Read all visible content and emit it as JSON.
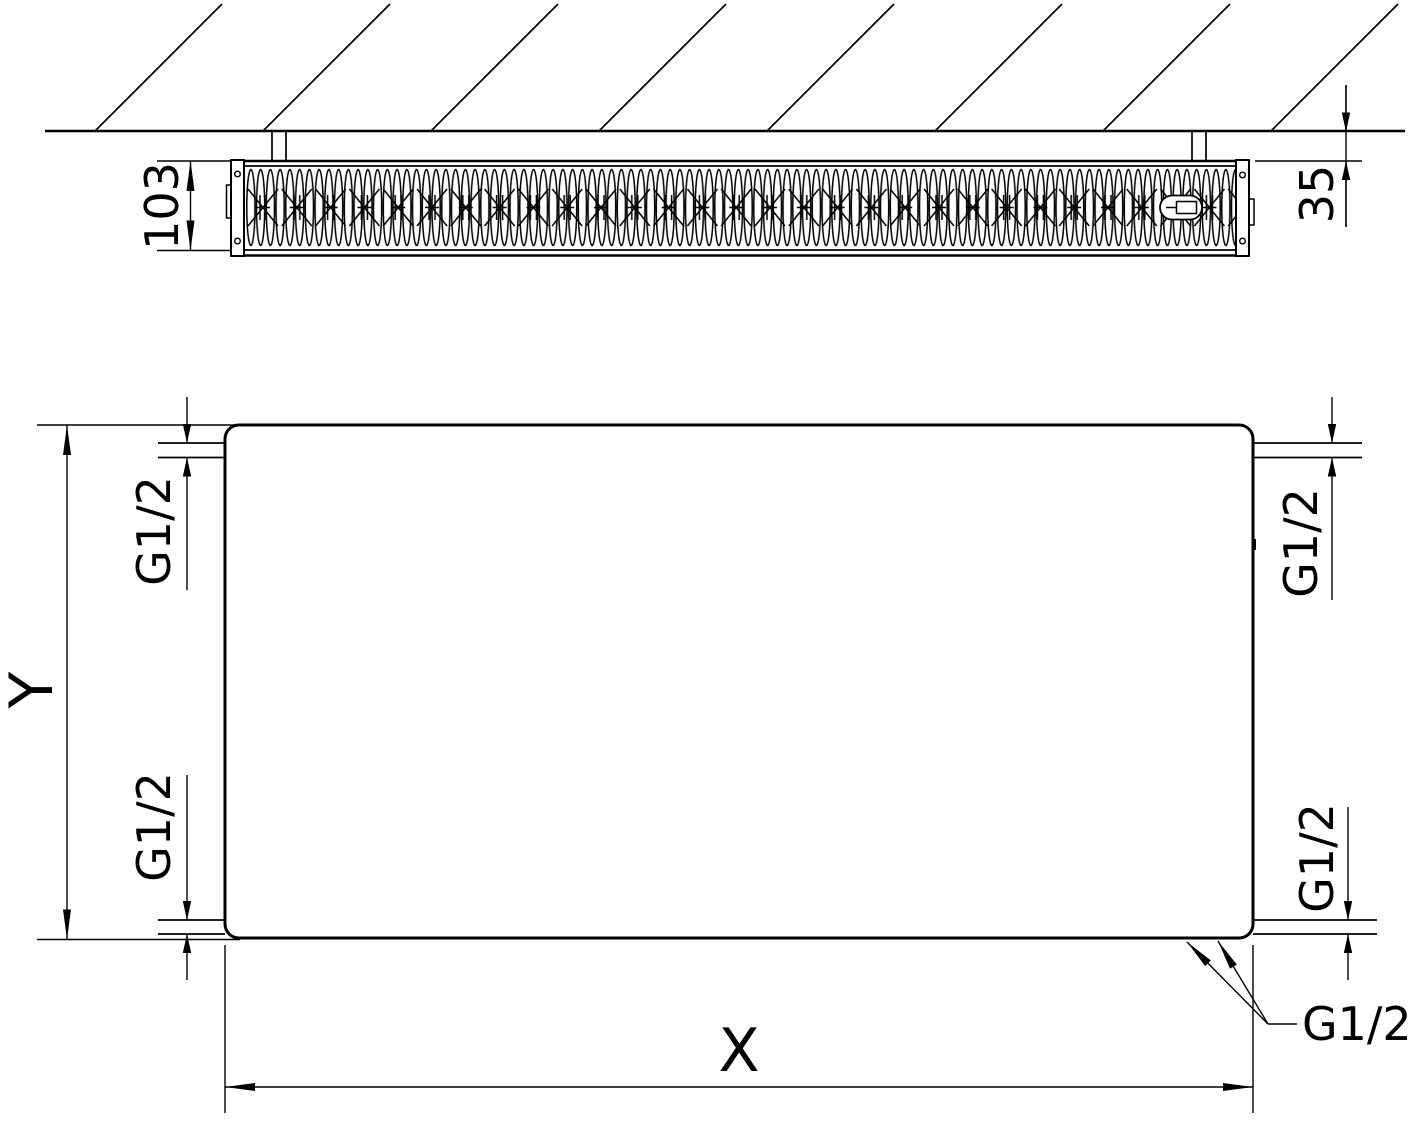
{
  "side_view": {
    "depth_label": "103",
    "wall_distance_label": "35"
  },
  "front_view": {
    "height_label": "Y",
    "width_label": "X",
    "thread_labels": {
      "top_left": "G1/2",
      "bottom_left": "G1/2",
      "top_right": "G1/2",
      "bottom_right": "G1/2",
      "bottom_callout": "G1/2"
    }
  },
  "colors": {
    "line": "#000000",
    "background": "#ffffff"
  }
}
